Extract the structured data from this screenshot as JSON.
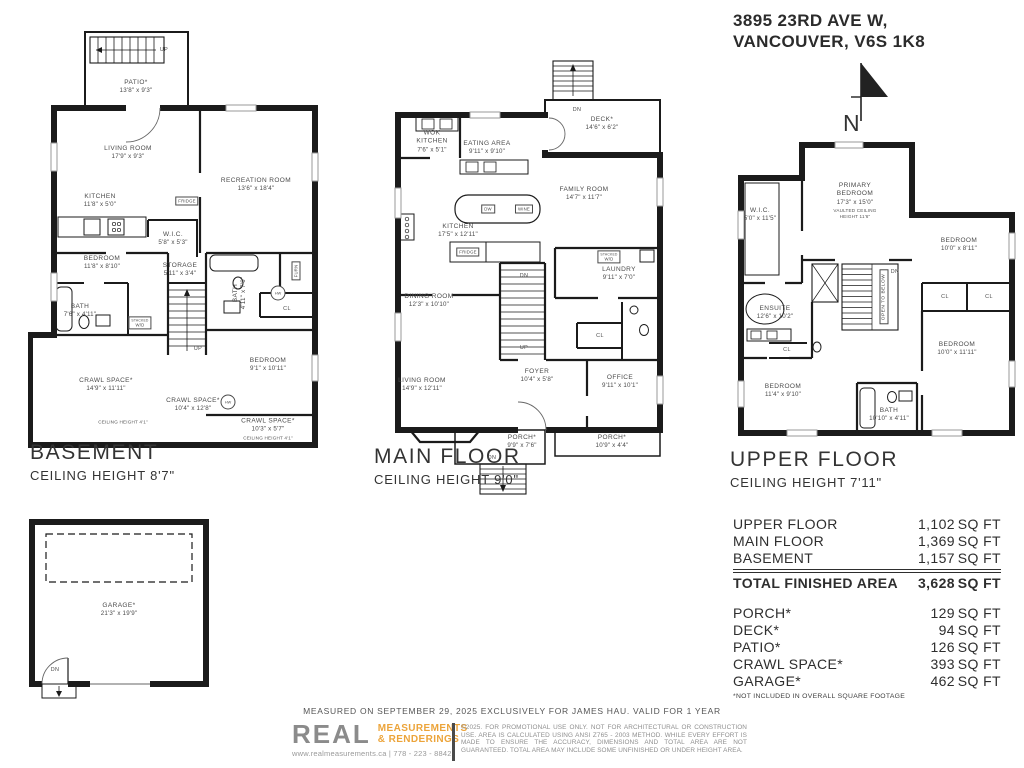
{
  "address": {
    "line1": "3895 23RD AVE W,",
    "line2": "VANCOUVER, V6S 1K8"
  },
  "compass": {
    "label": "N"
  },
  "basement": {
    "title": "BASEMENT",
    "ceiling": "CEILING HEIGHT 8'7\"",
    "patio": {
      "name": "PATIO*",
      "dims": "13'8\" x 9'3\""
    },
    "living": {
      "name": "LIVING ROOM",
      "dims": "17'9\" x 9'3\""
    },
    "kitchen": {
      "name": "KITCHEN",
      "dims": "11'8\" x 5'0\""
    },
    "rec": {
      "name": "RECREATION ROOM",
      "dims": "13'6\" x 18'4\""
    },
    "wic": {
      "name": "W.I.C.",
      "dims": "5'8\" x 5'3\""
    },
    "bedroom1": {
      "name": "BEDROOM",
      "dims": "11'8\" x 8'10\""
    },
    "storage": {
      "name": "STORAGE",
      "dims": "5'11\" x 3'4\""
    },
    "bath1": {
      "name": "BATH",
      "dims": "7'6\" x 4'11\""
    },
    "bath2": {
      "name": "BATH",
      "dims": "4'11\" x 7'6\""
    },
    "bedroom2": {
      "name": "BEDROOM",
      "dims": "9'1\" x 10'11\""
    },
    "crawl1": {
      "name": "CRAWL SPACE*",
      "dims": "14'9\" x 11'11\"",
      "note": "CEILING HEIGHT 4'1\""
    },
    "crawl2": {
      "name": "CRAWL SPACE*",
      "dims": "10'4\" x 12'8\""
    },
    "crawl3": {
      "name": "CRAWL SPACE*",
      "dims": "10'3\" x 5'7\"",
      "note": "CEILING HEIGHT 4'1\""
    },
    "tags": {
      "fridge": "FRIDGE",
      "stacked": "STACKED",
      "wd": "W/D",
      "furn": "FURN",
      "hw": "HW",
      "cl": "CL",
      "up_patio": "UP",
      "up_stairs": "UP"
    }
  },
  "main": {
    "title": "MAIN FLOOR",
    "ceiling": "CEILING HEIGHT 9'0\"",
    "wok": {
      "name": "WOK KITCHEN",
      "dims": "7'6\" x 5'1\""
    },
    "eating": {
      "name": "EATING AREA",
      "dims": "9'11\" x 9'10\""
    },
    "deck": {
      "name": "DECK*",
      "dims": "14'6\" x 6'2\""
    },
    "family": {
      "name": "FAMILY ROOM",
      "dims": "14'7\" x 11'7\""
    },
    "kitchen": {
      "name": "KITCHEN",
      "dims": "17'5\" x 12'11\""
    },
    "laundry": {
      "name": "LAUNDRY",
      "dims": "9'11\" x 7'0\""
    },
    "dining": {
      "name": "DINING ROOM",
      "dims": "12'3\" x 10'10\""
    },
    "living": {
      "name": "LIVING ROOM",
      "dims": "14'9\" x 12'11\""
    },
    "foyer": {
      "name": "FOYER",
      "dims": "10'4\" x 5'8\""
    },
    "office": {
      "name": "OFFICE",
      "dims": "9'11\" x 10'1\""
    },
    "porch1": {
      "name": "PORCH*",
      "dims": "9'9\" x 7'6\""
    },
    "porch2": {
      "name": "PORCH*",
      "dims": "10'9\" x 4'4\""
    },
    "tags": {
      "dw": "DW",
      "wine": "WINE",
      "fridge": "FRIDGE",
      "stacked": "STACKED",
      "wd": "W/D",
      "cl": "CL",
      "dn_deck": "DN",
      "dn_stairs": "DN",
      "up_stairs": "UP",
      "dn_porch": "DN"
    }
  },
  "upper": {
    "title": "UPPER FLOOR",
    "ceiling": "CEILING HEIGHT 7'11\"",
    "wic": {
      "name": "W.I.C.",
      "dims": "5'0\" x 11'5\""
    },
    "primary": {
      "name": "PRIMARY BEDROOM",
      "dims": "17'3\" x 15'0\"",
      "note": "VAULTED CEILING HEIGHT 11'6\""
    },
    "bedroom1": {
      "name": "BEDROOM",
      "dims": "10'0\" x 8'11\""
    },
    "ensuite": {
      "name": "ENSUITE",
      "dims": "12'6\" x 10'2\""
    },
    "bedroom2": {
      "name": "BEDROOM",
      "dims": "10'0\" x 11'11\""
    },
    "bedroom3": {
      "name": "BEDROOM",
      "dims": "11'4\" x 9'10\""
    },
    "bath": {
      "name": "BATH",
      "dims": "10'10\" x 4'11\""
    },
    "tags": {
      "open": "OPEN TO BELOW",
      "dn": "DN",
      "cl1": "CL",
      "cl2": "CL",
      "cl3": "CL"
    }
  },
  "garage": {
    "name": "GARAGE*",
    "dims": "21'3\" x 19'9\"",
    "dn": "DN"
  },
  "areas": {
    "unit": "SQ FT",
    "finished": [
      {
        "label": "UPPER FLOOR",
        "value": "1,102"
      },
      {
        "label": "MAIN FLOOR",
        "value": "1,369"
      },
      {
        "label": "BASEMENT",
        "value": "1,157"
      }
    ],
    "total": {
      "label": "TOTAL FINISHED AREA",
      "value": "3,628"
    },
    "unfinished": [
      {
        "label": "PORCH*",
        "value": "129"
      },
      {
        "label": "DECK*",
        "value": "94"
      },
      {
        "label": "PATIO*",
        "value": "126"
      },
      {
        "label": "CRAWL SPACE*",
        "value": "393"
      },
      {
        "label": "GARAGE*",
        "value": "462"
      }
    ],
    "footnote": "*NOT INCLUDED IN OVERALL SQUARE FOOTAGE"
  },
  "footer": {
    "measured": "MEASURED ON SEPTEMBER 29, 2025 EXCLUSIVELY FOR JAMES HAU. VALID FOR 1 YEAR",
    "logo": {
      "brand": "REAL",
      "tag1": "MEASUREMENTS",
      "tag2": "& RENDERINGS",
      "contact": "www.realmeasurements.ca | 778 - 223 - 8842"
    },
    "disclaimer": "©2025. FOR PROMOTIONAL USE ONLY. NOT FOR ARCHITECTURAL OR CONSTRUCTION USE. AREA IS CALCULATED USING ANSI Z765 - 2003 METHOD. WHILE EVERY EFFORT IS MADE TO ENSURE THE ACCURACY, DIMENSIONS AND TOTAL AREA ARE NOT GUARANTEED. TOTAL AREA MAY INCLUDE SOME UNFINISHED OR UNDER HEIGHT AREA."
  }
}
